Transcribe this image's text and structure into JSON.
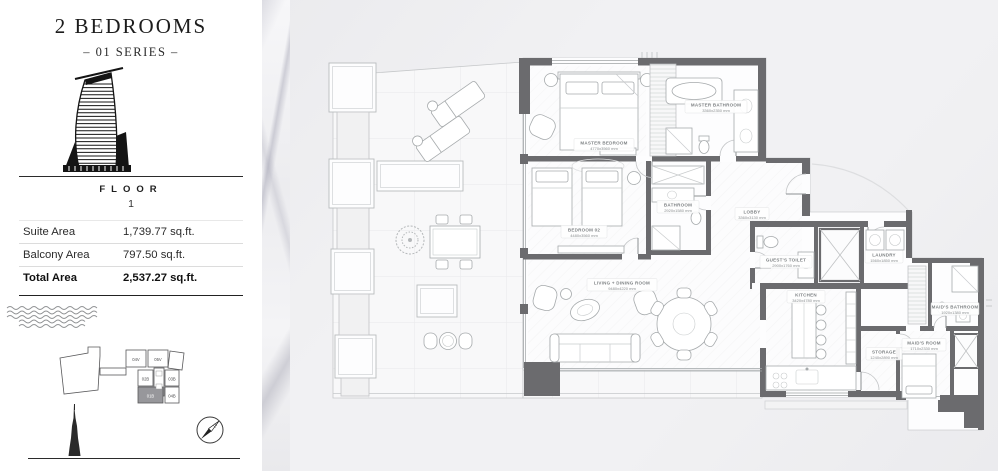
{
  "panel": {
    "title": "2 BEDROOMS",
    "series": "– 01 SERIES –",
    "floor_label": "FLOOR",
    "floor_value": "1",
    "area_table": {
      "rows": [
        {
          "label": "Suite Area",
          "value": "1,739.77 sq.ft."
        },
        {
          "label": "Balcony Area",
          "value": "797.50 sq.ft."
        },
        {
          "label": "Total Area",
          "value": "2,537.27 sq.ft."
        }
      ]
    },
    "keyplan": {
      "units": [
        {
          "label": "04V"
        },
        {
          "label": "05V"
        },
        {
          "label": "02B"
        },
        {
          "label": "03B"
        },
        {
          "label": "01B",
          "highlighted": true
        },
        {
          "label": "04B"
        }
      ],
      "highlight_color": "#97979b"
    }
  },
  "plan": {
    "rooms": [
      {
        "name": "MASTER BEDROOM",
        "dims": "4770x3560 mm"
      },
      {
        "name": "MASTER BATHROOM",
        "dims": "3360x2350 mm"
      },
      {
        "name": "BATHROOM",
        "dims": "2920x1580 mm"
      },
      {
        "name": "BEDROOM 02",
        "dims": "4480x3560 mm"
      },
      {
        "name": "LOBBY",
        "dims": "3360x3130 mm"
      },
      {
        "name": "GUEST'S TOILET",
        "dims": "2900x1760 mm"
      },
      {
        "name": "LAUNDRY",
        "dims": "1560x1850 mm"
      },
      {
        "name": "KITCHEN",
        "dims": "3420x4780 mm"
      },
      {
        "name": "LIVING + DINING ROOM",
        "dims": "9480x4220 mm"
      },
      {
        "name": "STORAGE",
        "dims": "1240x2890 mm"
      },
      {
        "name": "MAID'S ROOM",
        "dims": "1710x2330 mm"
      },
      {
        "name": "MAID'S BATHROOM",
        "dims": "1920x1380 mm"
      }
    ],
    "colors": {
      "wall": "#6b6b6e",
      "floor": "#fdfdfe",
      "label_text": "#84888a"
    }
  }
}
